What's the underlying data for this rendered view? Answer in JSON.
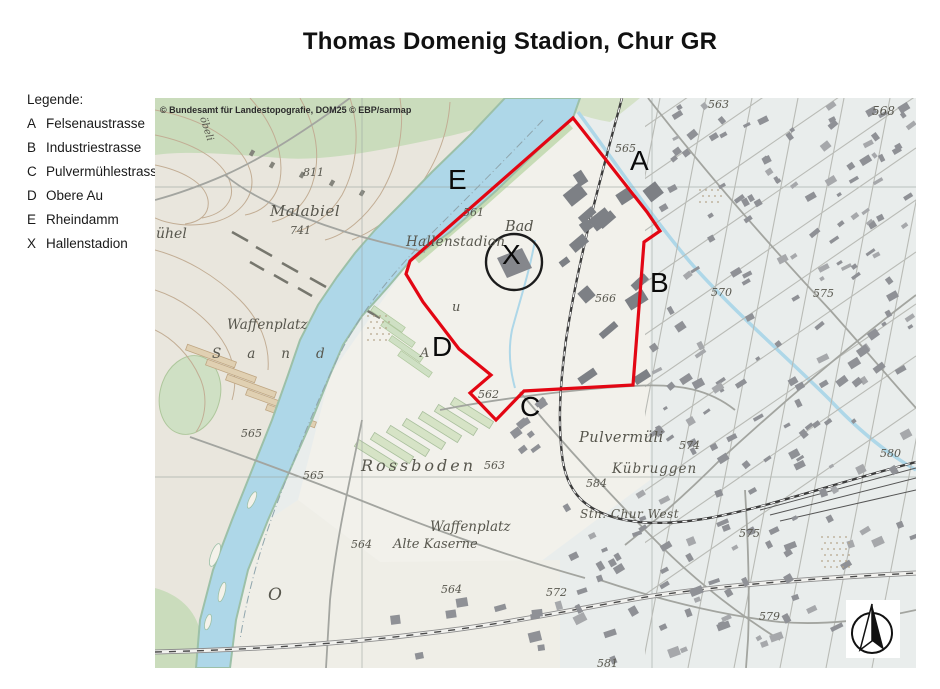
{
  "title": "Thomas Domenig Stadion, Chur GR",
  "legend": {
    "heading": "Legende:",
    "items": [
      {
        "key": "A",
        "label": "Felsenaustrasse"
      },
      {
        "key": "B",
        "label": "Industriestrasse"
      },
      {
        "key": "C",
        "label": "Pulvermühlestrasse"
      },
      {
        "key": "D",
        "label": "Obere Au"
      },
      {
        "key": "E",
        "label": "Rheindamm"
      },
      {
        "key": "X",
        "label": "Hallenstadion"
      }
    ]
  },
  "map": {
    "copyright": "© Bundesamt für Landestopografie, DOM25 © EBP/sarmap",
    "markers": [
      {
        "k": "A",
        "x": 630,
        "y": 170
      },
      {
        "k": "B",
        "x": 650,
        "y": 292
      },
      {
        "k": "C",
        "x": 520,
        "y": 416
      },
      {
        "k": "D",
        "x": 432,
        "y": 356
      },
      {
        "k": "E",
        "x": 448,
        "y": 189
      },
      {
        "k": "X",
        "x": 502,
        "y": 264
      }
    ],
    "labels": [
      {
        "t": "Malabiel",
        "x": 270,
        "y": 216,
        "s": 15,
        "ls": 0.5
      },
      {
        "t": "741",
        "x": 290,
        "y": 234,
        "s": 11
      },
      {
        "t": "811",
        "x": 303,
        "y": 176,
        "s": 11
      },
      {
        "t": "ühel",
        "x": 156,
        "y": 238,
        "s": 14
      },
      {
        "t": "öbeli",
        "x": 200,
        "y": 118,
        "s": 10,
        "rot": 72
      },
      {
        "t": "Hallenstadion",
        "x": 406,
        "y": 246,
        "s": 13.5,
        "ls": 0.3
      },
      {
        "t": "Bad",
        "x": 505,
        "y": 231,
        "s": 14.5
      },
      {
        "t": "561",
        "x": 463,
        "y": 216,
        "s": 11
      },
      {
        "t": "Waffenplatz",
        "x": 227,
        "y": 329,
        "s": 13.5
      },
      {
        "t": "Sand",
        "x": 212,
        "y": 358,
        "s": 13.5,
        "ls": 26
      },
      {
        "t": "u",
        "x": 452,
        "y": 311,
        "s": 13
      },
      {
        "t": "A",
        "x": 420,
        "y": 357,
        "s": 13
      },
      {
        "t": "O",
        "x": 268,
        "y": 600,
        "s": 17
      },
      {
        "t": "565",
        "x": 241,
        "y": 437,
        "s": 11
      },
      {
        "t": "565",
        "x": 303,
        "y": 479,
        "s": 11
      },
      {
        "t": "Rossboden",
        "x": 361,
        "y": 471,
        "s": 16,
        "ls": 3
      },
      {
        "t": "563",
        "x": 484,
        "y": 469,
        "s": 11
      },
      {
        "t": "Waffenplatz",
        "x": 430,
        "y": 531,
        "s": 13.5
      },
      {
        "t": "Alte Kaserne",
        "x": 393,
        "y": 548,
        "s": 13
      },
      {
        "t": "564",
        "x": 351,
        "y": 548,
        "s": 11
      },
      {
        "t": "564",
        "x": 441,
        "y": 593,
        "s": 11
      },
      {
        "t": "562",
        "x": 478,
        "y": 398,
        "s": 11
      },
      {
        "t": "563",
        "x": 708,
        "y": 108,
        "s": 11
      },
      {
        "t": "565",
        "x": 615,
        "y": 152,
        "s": 11
      },
      {
        "t": "568",
        "x": 872,
        "y": 115,
        "s": 12
      },
      {
        "t": "566",
        "x": 595,
        "y": 302,
        "s": 11
      },
      {
        "t": "570",
        "x": 711,
        "y": 296,
        "s": 11
      },
      {
        "t": "575",
        "x": 813,
        "y": 297,
        "s": 11
      },
      {
        "t": "575",
        "x": 739,
        "y": 537,
        "s": 11
      },
      {
        "t": "574",
        "x": 679,
        "y": 449,
        "s": 11
      },
      {
        "t": "580",
        "x": 880,
        "y": 457,
        "s": 11
      },
      {
        "t": "584",
        "x": 586,
        "y": 487,
        "s": 11
      },
      {
        "t": "Pulvermüli",
        "x": 579,
        "y": 442,
        "s": 14.5,
        "ls": 0.5
      },
      {
        "t": "Kübruggen",
        "x": 612,
        "y": 473,
        "s": 13.5,
        "ls": 1
      },
      {
        "t": "Stn. Chur West",
        "x": 580,
        "y": 518,
        "s": 12,
        "ls": 0.5
      },
      {
        "t": "579",
        "x": 759,
        "y": 620,
        "s": 11
      },
      {
        "t": "572",
        "x": 546,
        "y": 596,
        "s": 11
      },
      {
        "t": "581",
        "x": 597,
        "y": 667,
        "s": 11
      }
    ],
    "colors": {
      "boundary": "#e30613",
      "water": "#aed7e8",
      "forest": "#cadcbc",
      "building": "#8f9196"
    }
  }
}
